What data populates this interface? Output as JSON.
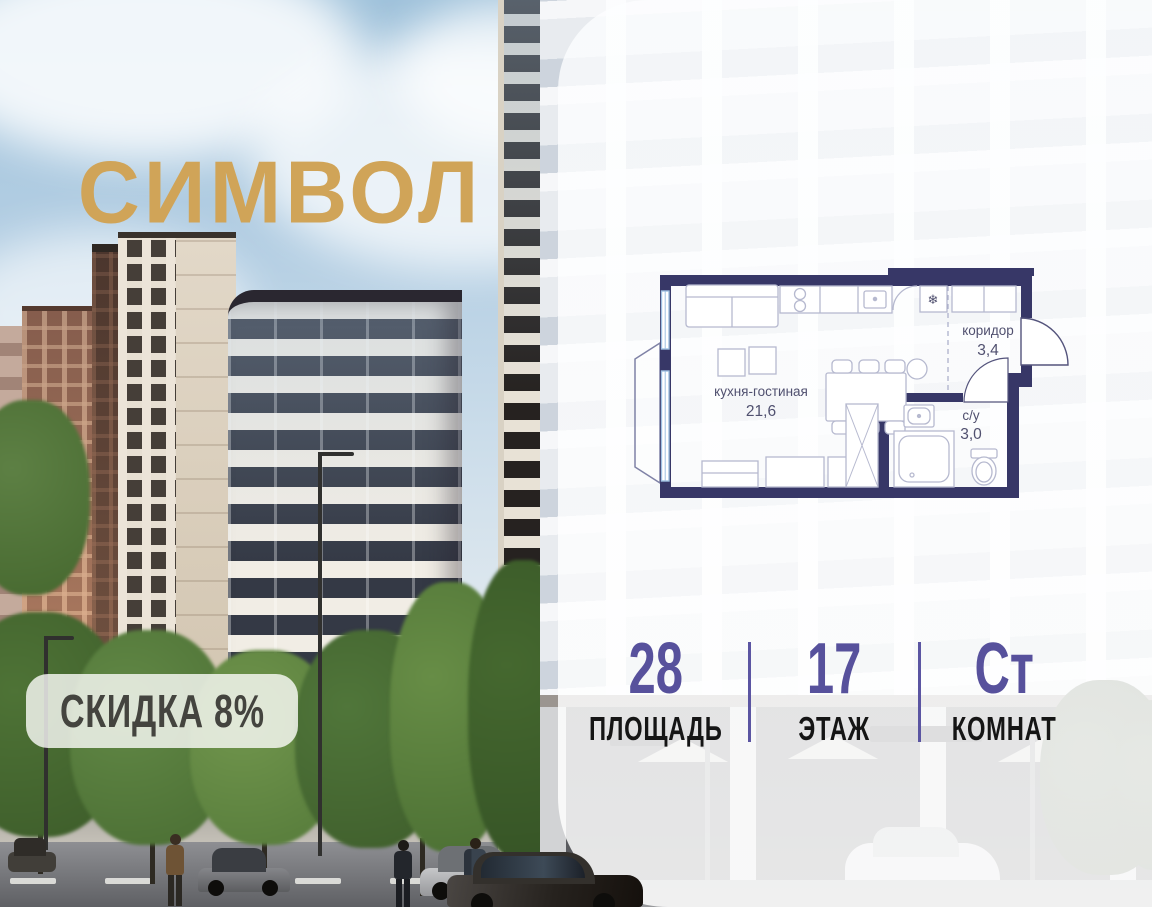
{
  "brand": {
    "name": "СИМВОЛ"
  },
  "badge": {
    "label": "СКИДКА 8%"
  },
  "floor_plan": {
    "rooms": [
      {
        "name": "кухня-гостиная",
        "area": "21,6"
      },
      {
        "name": "коридор",
        "area": "3,4"
      },
      {
        "name": "с/у",
        "area": "3,0"
      }
    ]
  },
  "stats": {
    "items": [
      {
        "value": "28",
        "label": "ПЛОЩАДЬ"
      },
      {
        "value": "17",
        "label": "ЭТАЖ"
      },
      {
        "value": "Ст",
        "label": "КОМНАТ"
      }
    ]
  },
  "colors": {
    "logo_gold": "#d0a458",
    "accent_purple": "#57519c",
    "plan_wall_navy": "#373767",
    "plan_window_blue": "#9ec0e2"
  }
}
